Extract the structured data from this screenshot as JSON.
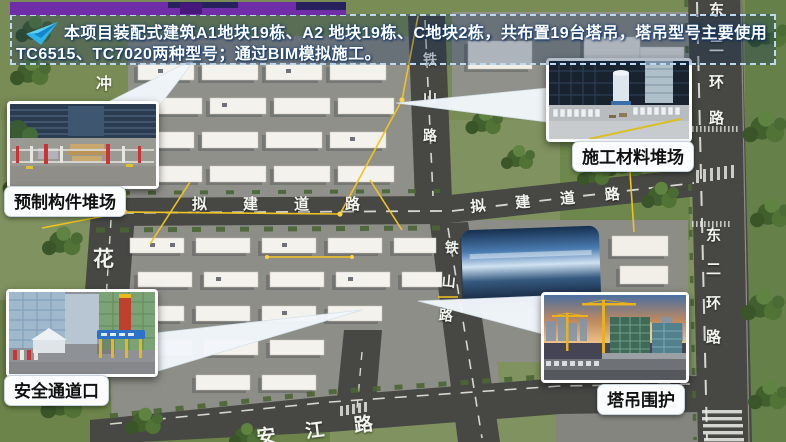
{
  "banner": {
    "line1": "本项目装配式建筑A1地块19栋、A2 地块19栋、C地块2栋，共布置19台塔吊，塔吊型号主要使用",
    "line2": "TC6515、TC7020两种型号；通过BIM模拟施工。"
  },
  "callouts": [
    {
      "id": "prefab-yard",
      "label": "预制构件堆场"
    },
    {
      "id": "material-yard",
      "label": "施工材料堆场"
    },
    {
      "id": "safety-entrance",
      "label": "安全通道口"
    },
    {
      "id": "crane-enclosure",
      "label": "塔吊围护"
    }
  ],
  "road_labels": {
    "tieshan_upper": "铁山路",
    "tieshan_lower": "铁山路",
    "planned_left": "拟建道路",
    "planned_right": "拟建道路",
    "ring_upper": "东二环路",
    "ring_lower": "东二环路",
    "hua": "花",
    "chong": "冲",
    "anjiang": "安江路"
  },
  "colors": {
    "accent_arrow": "#2fb3e8",
    "top_bar": "#6f2da8",
    "banner_border": "#bcd9f0",
    "crane_line": "#f0c420",
    "road": "#474844",
    "label_bg": "#fbfcfd"
  }
}
